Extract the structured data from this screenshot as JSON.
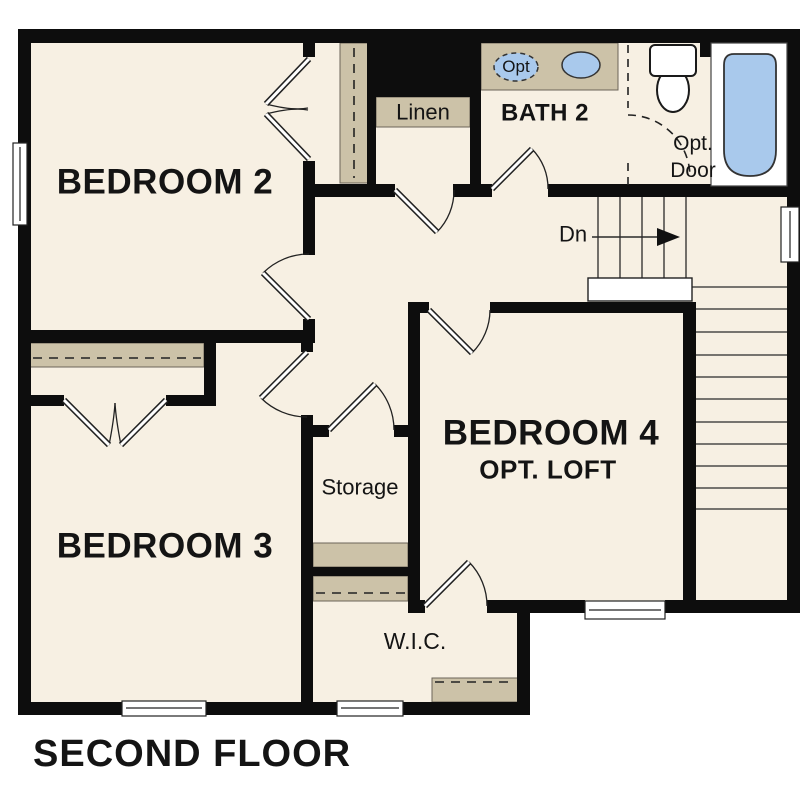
{
  "plan": {
    "title": "SECOND FLOOR",
    "rooms": {
      "bedroom2": {
        "label": "BEDROOM 2"
      },
      "bedroom3": {
        "label": "BEDROOM 3"
      },
      "bedroom4": {
        "label": "BEDROOM 4",
        "sublabel": "OPT. LOFT"
      },
      "bath2": {
        "label": "BATH 2"
      },
      "linen": {
        "label": "Linen"
      },
      "storage": {
        "label": "Storage"
      },
      "wic": {
        "label": "W.I.C."
      }
    },
    "annotations": {
      "stairs_down": "Dn",
      "opt_door_line1": "Opt.",
      "opt_door_line2": "Door",
      "opt_sink": "Opt"
    },
    "colors": {
      "wall": "#0d0d0d",
      "floor": "#f7f0e3",
      "band": "#ccc2a8",
      "fixture_blue": "#a9c9ec",
      "line": "#222222",
      "background": "#ffffff"
    }
  }
}
